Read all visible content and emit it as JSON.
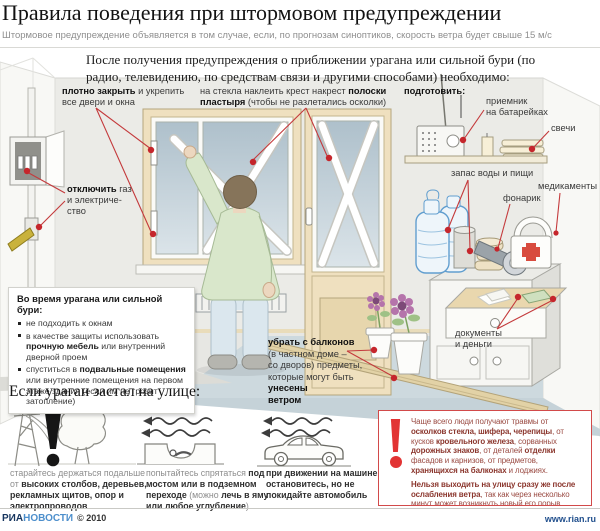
{
  "header": {
    "title": "Правила поведения при штормовом предупреждении",
    "subtitle": "Штормовое предупреждение объявляется в том случае, если, по прогнозам синоптиков, скорость ветра будет свыше 15 м/с"
  },
  "intro": {
    "text": "После получения предупреждения о приближении урагана или сильной бури (по радио, телевидению, по средствам связи и другими способами) необходимо:"
  },
  "room": {
    "labels": {
      "close": [
        {
          "t": "плотно закрыть",
          "b": 1
        },
        {
          "t": " и укрепить"
        },
        {
          "br": 1
        },
        {
          "t": "все двери и окна"
        }
      ],
      "tape": [
        {
          "t": "на стекла наклеить крест накрест "
        },
        {
          "t": "полоски",
          "b": 1
        },
        {
          "br": 1
        },
        {
          "t": "пластыря",
          "b": 1
        },
        {
          "t": " (чтобы не разлетались осколки)"
        }
      ],
      "prepare": [
        {
          "t": "подготовить:",
          "b": 1
        }
      ],
      "radio": [
        {
          "t": "приемник"
        },
        {
          "br": 1
        },
        {
          "t": "на батарейках"
        }
      ],
      "candles": [
        {
          "t": "свечи"
        }
      ],
      "gas": [
        {
          "t": "отключить",
          "b": 1
        },
        {
          "t": " газ"
        },
        {
          "br": 1
        },
        {
          "t": "и электриче-"
        },
        {
          "br": 1
        },
        {
          "t": "ство"
        }
      ],
      "water": [
        {
          "t": "запас воды и пищи"
        }
      ],
      "flashlight": [
        {
          "t": "фонарик"
        }
      ],
      "meds": [
        {
          "t": "медикаменты"
        }
      ],
      "docs": [
        {
          "t": "документы"
        },
        {
          "br": 1
        },
        {
          "t": "и деньги"
        }
      ],
      "balcony": [
        {
          "t": "убрать с балконов",
          "b": 1
        },
        {
          "br": 1
        },
        {
          "t": "(в частном доме –"
        },
        {
          "br": 1
        },
        {
          "t": "со дворов) предметы,"
        },
        {
          "br": 1
        },
        {
          "t": "которые могут быть "
        },
        {
          "t": "унесены",
          "b": 1
        },
        {
          "br": 1
        },
        {
          "t": "ветром",
          "b": 1
        }
      ]
    }
  },
  "during": {
    "title": "Во время урагана или сильной бури:",
    "items": [
      [
        {
          "t": "не подходить к окнам"
        }
      ],
      [
        {
          "t": "в качестве защиты использовать "
        },
        {
          "t": "прочную мебель",
          "b": 1
        },
        {
          "t": " или внутренний дверной проем"
        }
      ],
      [
        {
          "t": "спуститься в "
        },
        {
          "t": "подвальные помещения",
          "b": 1
        },
        {
          "t": " или внутренние помещения на первом этаже здания (если им не грозит затопление)"
        }
      ]
    ]
  },
  "street": {
    "heading": "Если ураган застал на улице:",
    "items": [
      [
        {
          "t": "старайтесь держаться подальше от ",
          "m": 1
        },
        {
          "t": "высоких столбов, деревьев, рекламных щитов, опор и электропроводов",
          "b": 1
        }
      ],
      [
        {
          "t": "попытайтесь спрятаться ",
          "m": 1
        },
        {
          "t": "под мостом или в подземном переходе",
          "b": 1
        },
        {
          "t": " (можно ",
          "m": 1
        },
        {
          "t": "лечь в яму или любое углубление",
          "b": 1
        },
        {
          "t": ")",
          "m": 1
        }
      ],
      [
        {
          "t": "при движении на машине, остановитесь, но не покидайте автомобиль",
          "b": 1
        }
      ]
    ]
  },
  "warning": {
    "paragraphs": [
      [
        {
          "t": "Чаще всего люди получают травмы от "
        },
        {
          "t": "осколков стекла, шифера, черепицы",
          "b": 1
        },
        {
          "t": ", от кусков "
        },
        {
          "t": "кровельного железа",
          "b": 1
        },
        {
          "t": ", сорванных "
        },
        {
          "t": "дорожных знаков",
          "b": 1
        },
        {
          "t": ", от деталей "
        },
        {
          "t": "отделки",
          "b": 1
        },
        {
          "t": " фасадов и карнизов, от предметов, "
        },
        {
          "t": "хранящихся на балконах",
          "b": 1
        },
        {
          "t": " и лоджиях."
        }
      ],
      [
        {
          "t": "Нельзя выходить на улицу сразу же после ослабления ветра",
          "b": 1
        },
        {
          "t": ", так как через несколько минут может возникнуть новый его порыв"
        }
      ]
    ]
  },
  "footer": {
    "brand_ria": "РИА",
    "brand_novosti": "НОВОСТИ",
    "copyright": "© 2010",
    "site": "www.rian.ru"
  },
  "colors": {
    "accent_red": "#cc3a3c",
    "warning_text": "#9a4a42",
    "frame_cream": "#efe0bf",
    "glass_blue": "#aec0cb",
    "brand_dark_blue": "#16355e",
    "brand_light_blue": "#4d8fcc"
  },
  "icons": {
    "warning": "exclamation-mark",
    "wind": "wavy-arrows-left",
    "supplies": [
      "radio",
      "candles",
      "water-bottles",
      "canned-food",
      "flashlight",
      "first-aid-kit"
    ],
    "street": [
      "power-pole",
      "tree",
      "underpass",
      "car"
    ]
  }
}
